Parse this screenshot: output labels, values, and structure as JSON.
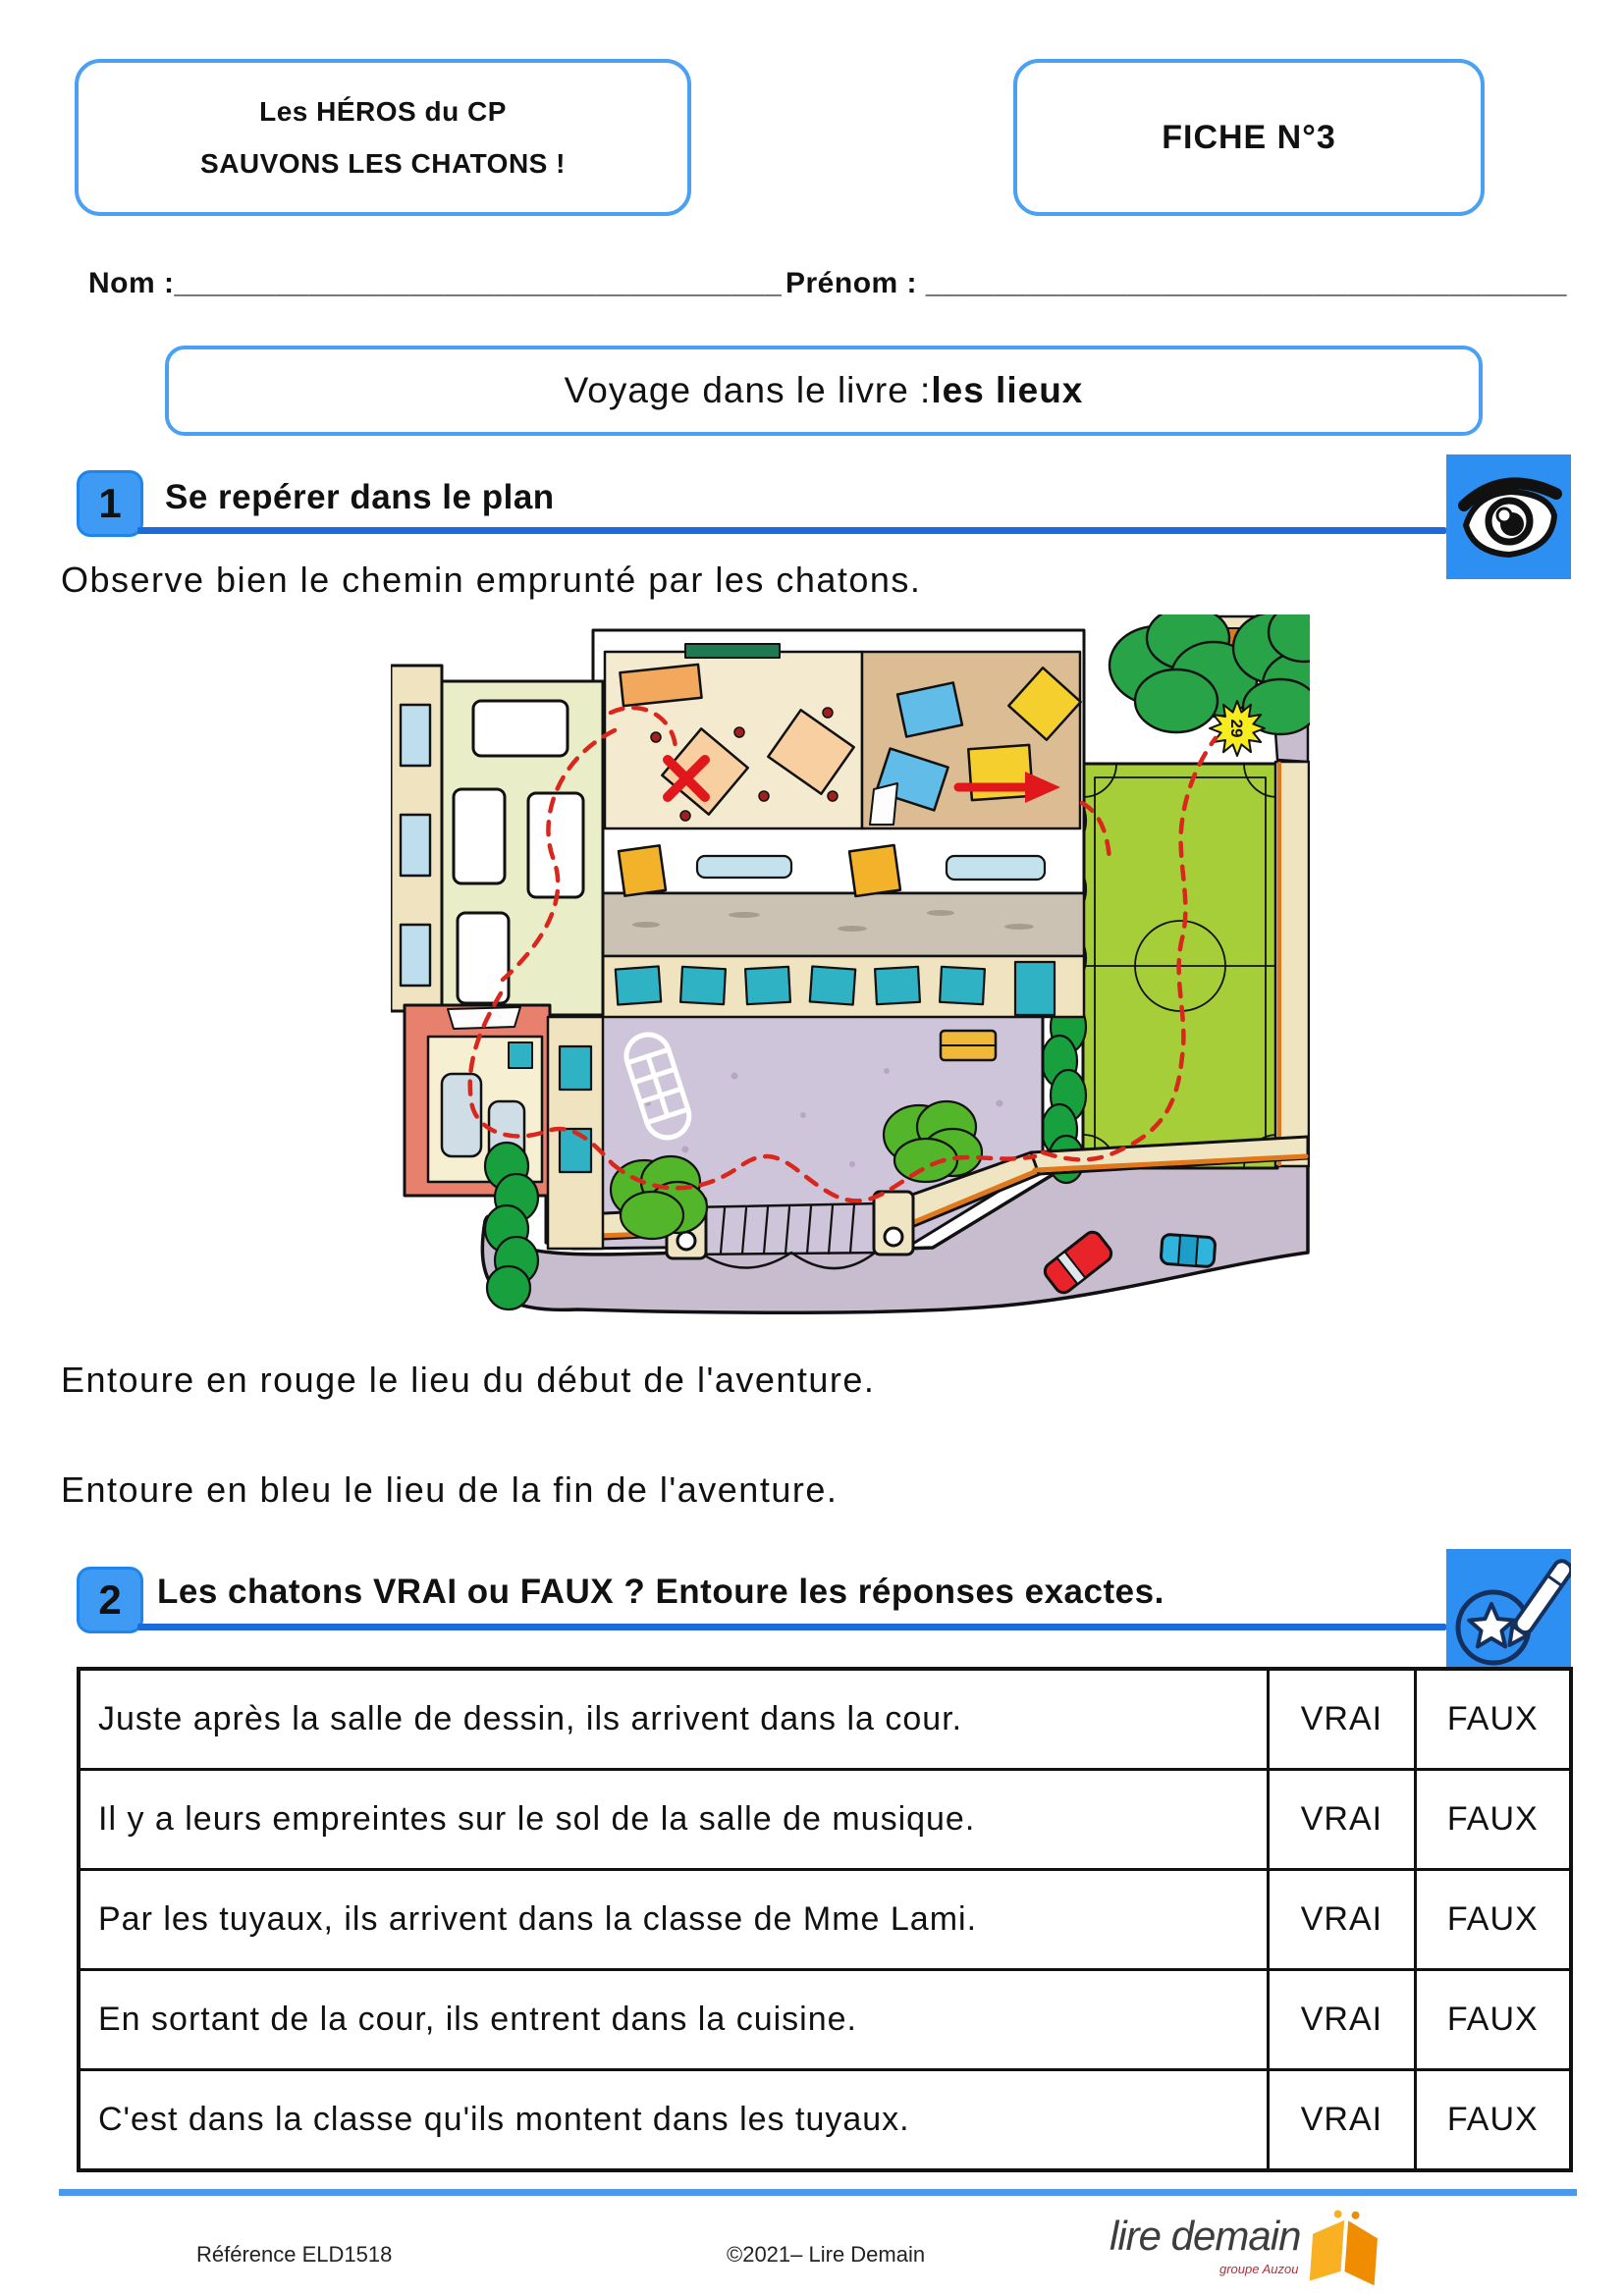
{
  "header": {
    "series_line1": "Les HÉROS du CP",
    "series_line2": "SAUVONS LES CHATONS !",
    "fiche": "FICHE N°3"
  },
  "identity": {
    "nom_label": "Nom :",
    "nom_line": "____________________________________",
    "prenom_label": "Prénom :",
    "prenom_line": "______________________________________"
  },
  "title": {
    "prefix": "Voyage dans le livre : ",
    "bold": "les lieux"
  },
  "section1": {
    "number": "1",
    "title": "Se repérer dans le plan",
    "instruction": "Observe bien le chemin emprunté par les chatons.",
    "consigne_rouge": "Entoure en rouge le lieu du début de l'aventure.",
    "consigne_bleu": "Entoure en bleu le lieu de la fin de l'aventure."
  },
  "map": {
    "star_label": "29"
  },
  "section2": {
    "number": "2",
    "title": "Les chatons VRAI ou FAUX ? Entoure les réponses exactes."
  },
  "table": {
    "vrai_label": "VRAI",
    "faux_label": "FAUX",
    "rows": [
      {
        "statement": "Juste après la salle de dessin, ils arrivent dans la cour."
      },
      {
        "statement": "Il y a leurs empreintes sur le sol de la salle de musique."
      },
      {
        "statement": "Par les tuyaux, ils arrivent dans la classe de Mme Lami."
      },
      {
        "statement": "En sortant de la cour, ils entrent dans la cuisine."
      },
      {
        "statement": "C'est dans la classe qu'ils montent dans les tuyaux."
      }
    ]
  },
  "footer": {
    "reference": "Référence ELD1518",
    "copyright": "©2021– Lire Demain",
    "logo_text": "lire demain",
    "logo_subtext": "groupe Auzou"
  },
  "colors": {
    "accent_blue": "#4aa0f2",
    "underline_blue": "#1b6bd8",
    "icon_blue": "#2e8ff2",
    "path_red": "#d8281e",
    "field_green": "#a6ce38",
    "hedge_green": "#18a03e",
    "courtyard_purple": "#cfc5da"
  }
}
